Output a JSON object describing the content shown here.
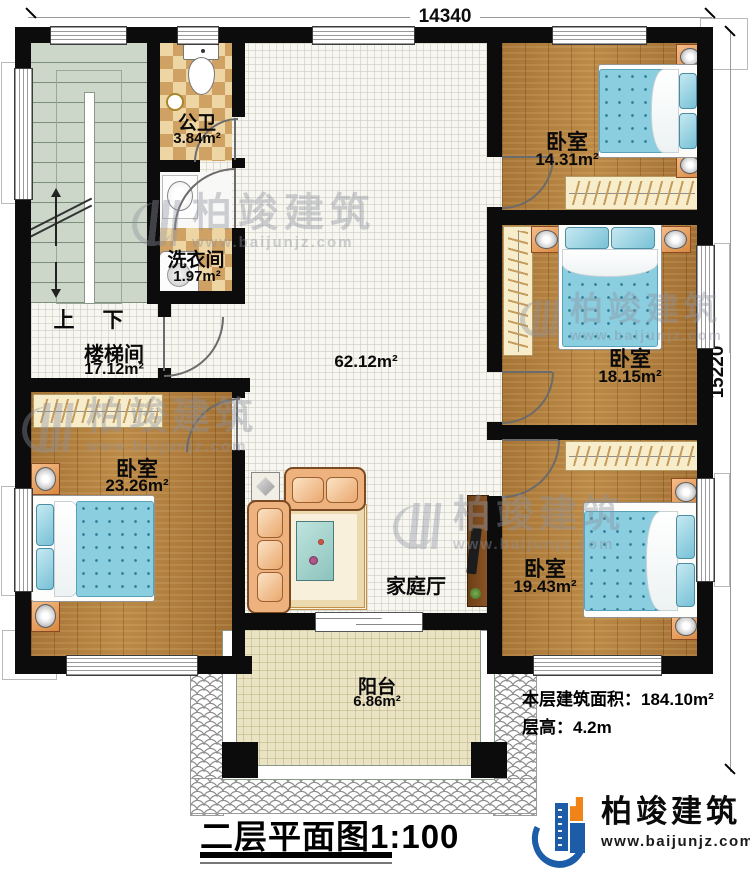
{
  "dimensions": {
    "width": "14340",
    "height": "15220"
  },
  "stairs": {
    "up_label": "上",
    "down_label": "下"
  },
  "rooms": {
    "bathroom": {
      "name": "公卫",
      "area": "3.84m²"
    },
    "laundry": {
      "name": "洗衣间",
      "area": "1.97m²"
    },
    "stairwell": {
      "name": "楼梯间",
      "area": "17.12m²"
    },
    "hall": {
      "area": "62.12m²"
    },
    "family_hall": {
      "name": "家庭厅"
    },
    "bedroom_top_right": {
      "name": "卧室",
      "area": "14.31m²"
    },
    "bedroom_mid_right": {
      "name": "卧室",
      "area": "18.15m²"
    },
    "bedroom_bottom_right": {
      "name": "卧室",
      "area": "19.43m²"
    },
    "bedroom_left": {
      "name": "卧室",
      "area": "23.26m²"
    },
    "balcony": {
      "name": "阳台",
      "area": "6.86m²"
    }
  },
  "annotations": {
    "floor_area_label": "本层建筑面积：184.10m²",
    "floor_height_label": "层高：4.2m"
  },
  "title": "二层平面图1:100",
  "brand": {
    "name": "柏竣建筑",
    "website": "www.baijunjz.com"
  },
  "watermark": {
    "name": "柏竣建筑",
    "website": "www.baijunjz.com"
  },
  "colors": {
    "wall": "#0c0c0c",
    "wood_floor": "#b3813f",
    "tile_checker_light": "#eed6a4",
    "tile_checker_dark": "#cfa263",
    "stair_floor": "#ccd6c9",
    "bed": "#8acee0",
    "balcony_floor": "#ebe4c4",
    "logo_blue": "#1d5ca8",
    "logo_orange": "#f08418"
  }
}
